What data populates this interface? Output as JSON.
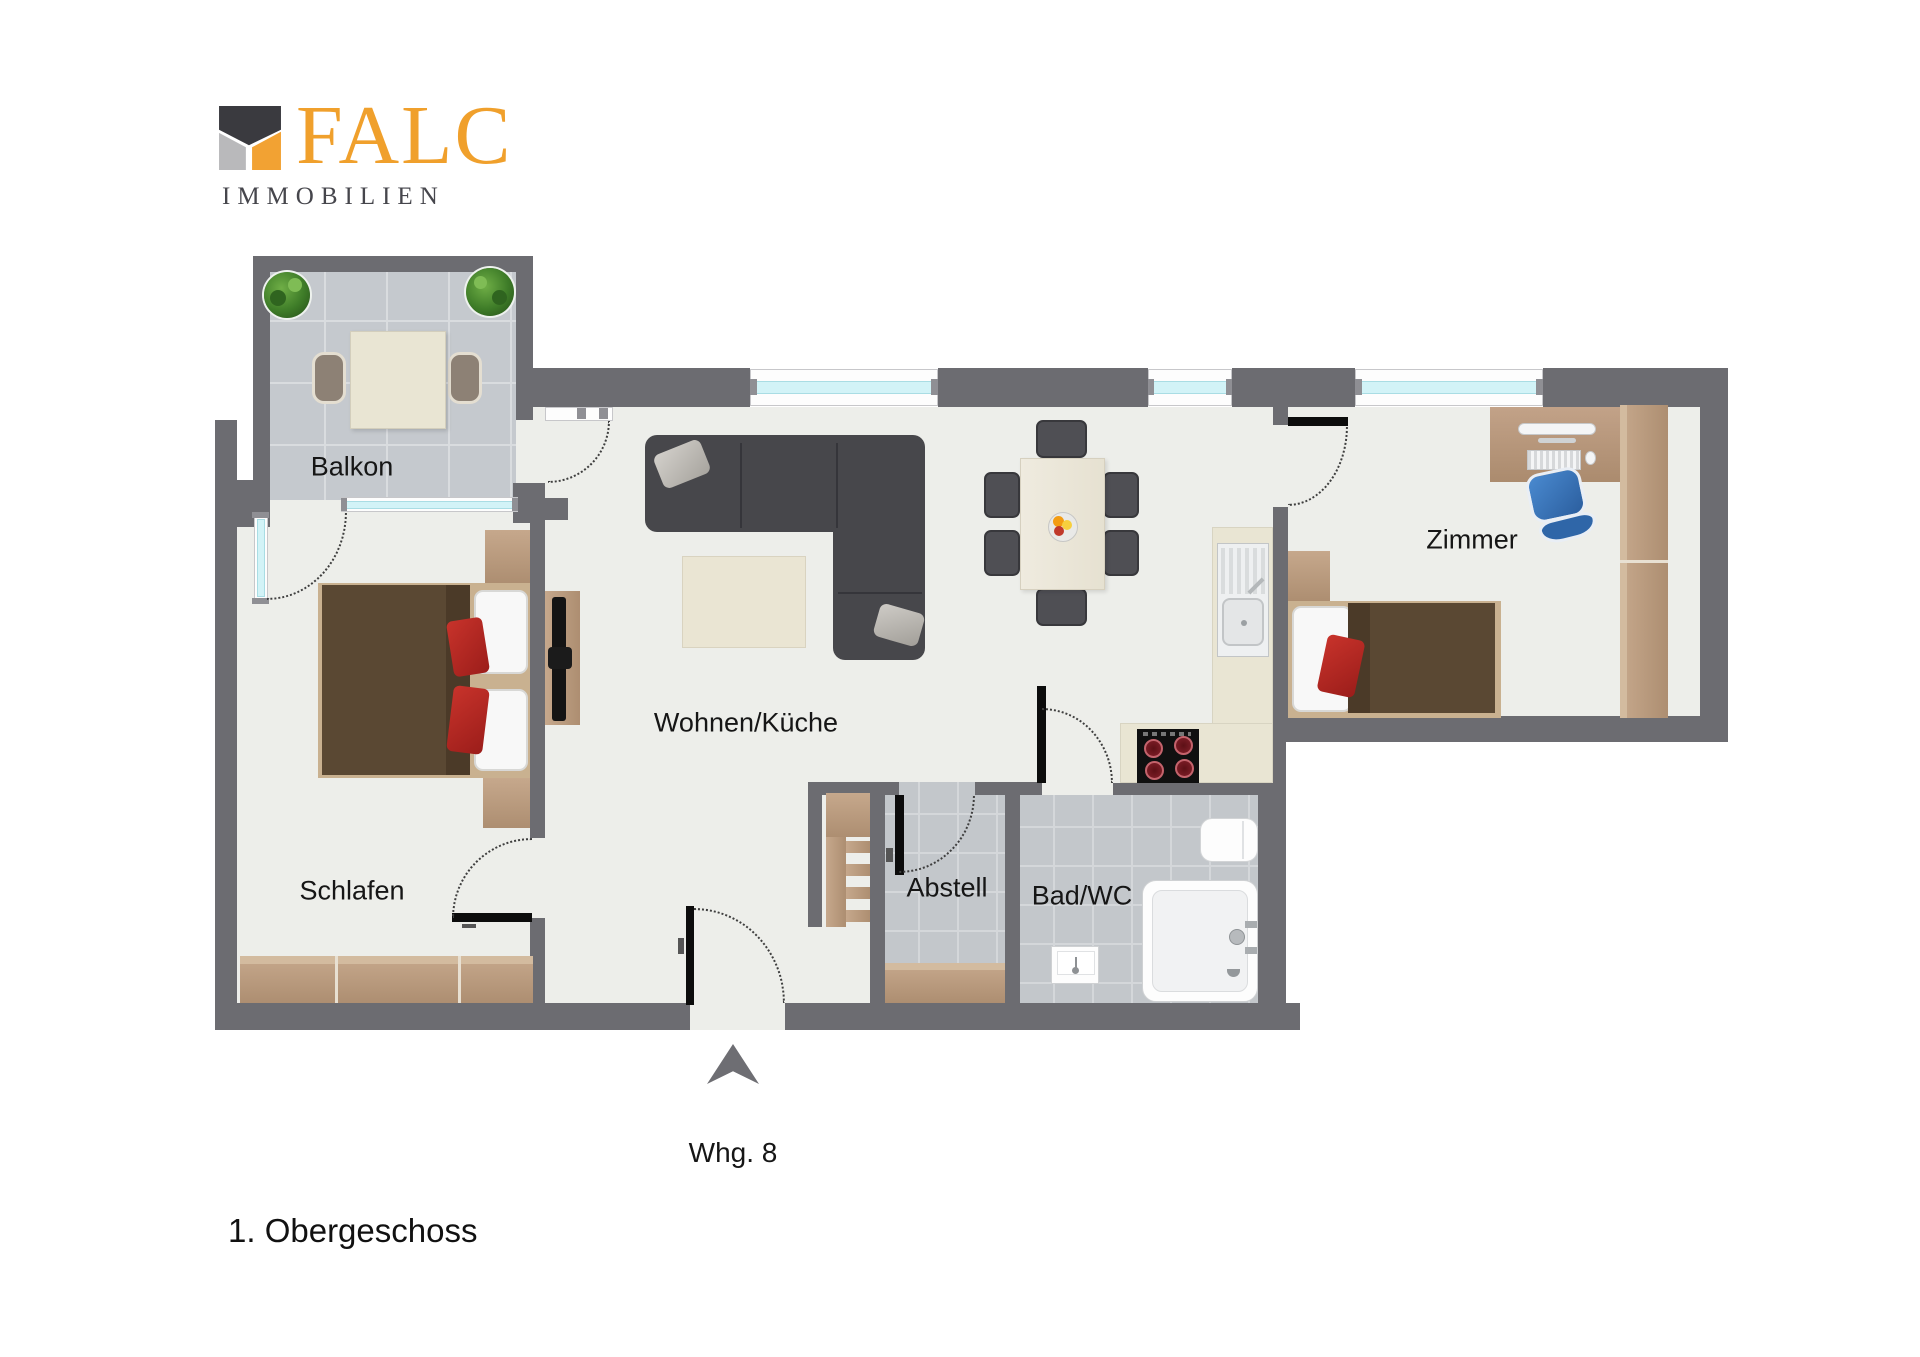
{
  "logo": {
    "brand": "FALC",
    "subtitle": "IMMOBILIEN"
  },
  "plan": {
    "rooms": [
      {
        "id": "balkon",
        "label": "Balkon"
      },
      {
        "id": "schlafen",
        "label": "Schlafen"
      },
      {
        "id": "wohnen_kueche",
        "label": "Wohnen/Küche"
      },
      {
        "id": "abstell",
        "label": "Abstell"
      },
      {
        "id": "bad_wc",
        "label": "Bad/WC"
      },
      {
        "id": "zimmer",
        "label": "Zimmer"
      }
    ],
    "entrance_label": "Whg. 8"
  },
  "footer": {
    "floor_label": "1. Obergeschoss"
  },
  "colors": {
    "wall": "#6c6c71",
    "brand_orange": "#f0a02c",
    "window_glass": "#d2f3f7",
    "floor": "#edeeea",
    "accent_red": "#c8332b"
  }
}
